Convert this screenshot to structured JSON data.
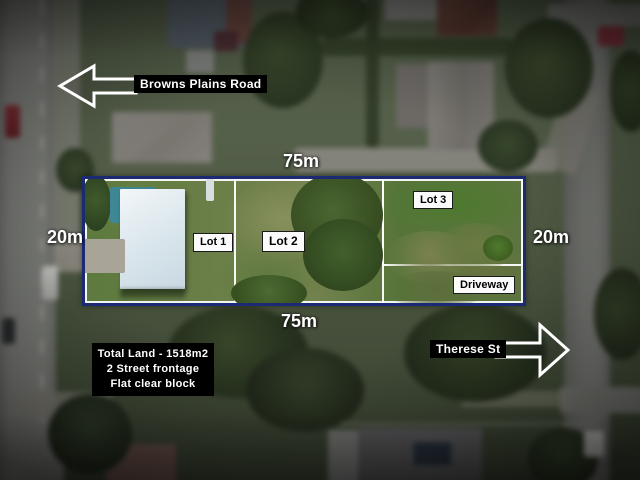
{
  "labels": {
    "road_top": "Browns Plains Road",
    "street_right": "Therese St",
    "dim_top": "75m",
    "dim_bottom": "75m",
    "dim_left": "20m",
    "dim_right": "20m",
    "lot1": "Lot 1",
    "lot2": "Lot 2",
    "lot3": "Lot 3",
    "driveway": "Driveway"
  },
  "summary": {
    "total_land": "Total Land - 1518m2",
    "frontage": "2 Street frontage",
    "block_desc": "Flat clear block"
  },
  "colors": {
    "boundary": "#1c2a74",
    "lot_outline": "#ffffff",
    "label_dark_bg": "#000000",
    "label_light_bg": "#fbfbfb"
  }
}
